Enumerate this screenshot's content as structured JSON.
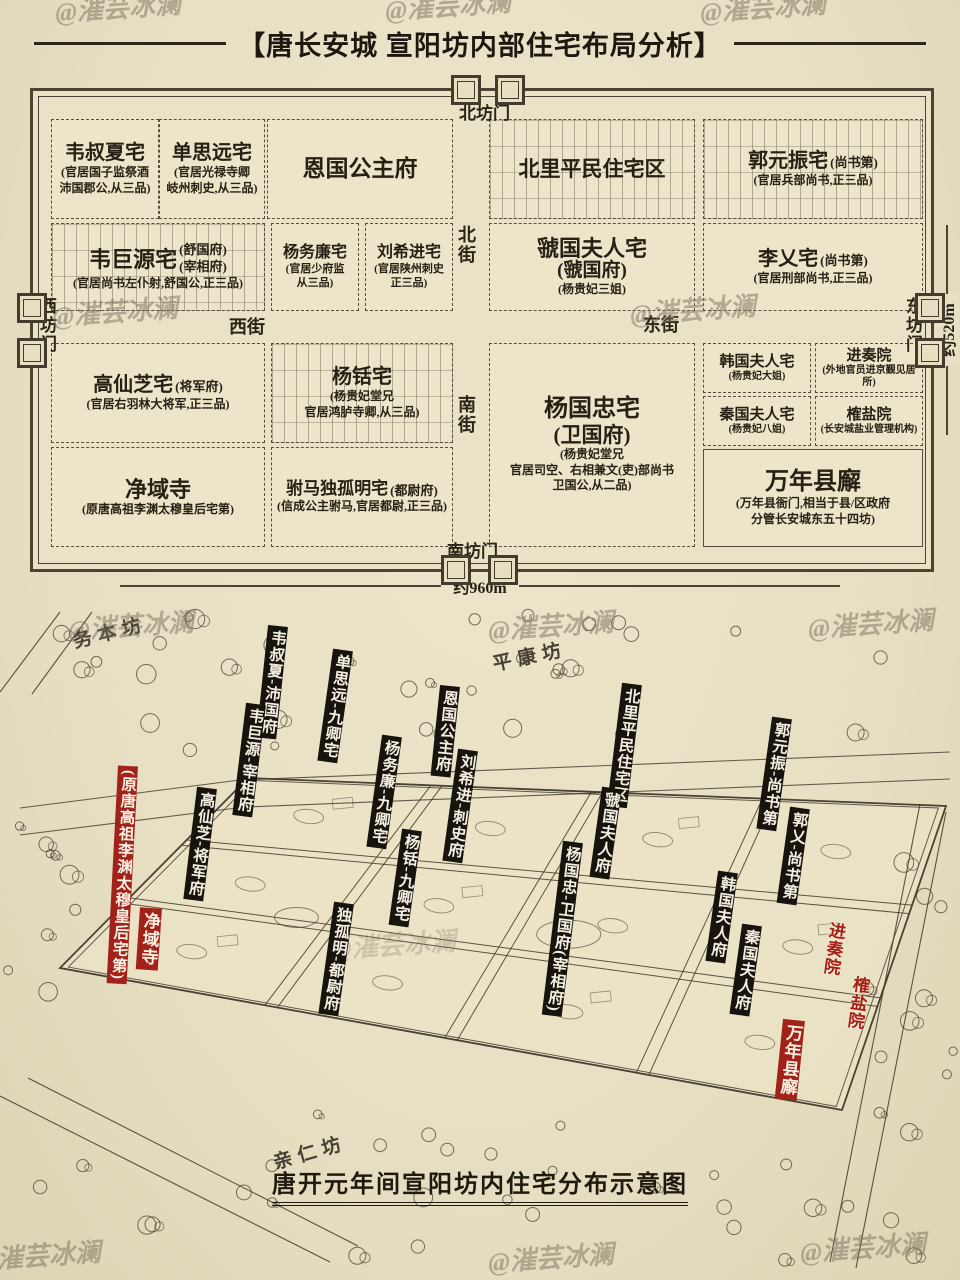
{
  "watermark": "@漼芸冰澜",
  "header": {
    "title": "【唐长安城 宣阳坊内部住宅布局分析】"
  },
  "plan": {
    "gates": {
      "north": "北坊门",
      "south": "南坊门",
      "west": "西坊门",
      "east": "东坊门"
    },
    "streets": {
      "north": "北街",
      "south": "南街",
      "west": "西街",
      "east": "东街"
    },
    "scale": {
      "width": "约960m",
      "height": "约520m"
    },
    "cells": {
      "weishuxia": {
        "name": "韦叔夏宅",
        "sub": "(官居国子监祭酒\n沛国郡公,从三品)"
      },
      "shansiyuan": {
        "name": "单思远宅",
        "sub": "(官居光禄寺卿\n岐州刺史,从三品)"
      },
      "enguo": {
        "name": "恩国公主府"
      },
      "beili": {
        "name": "北里平民住宅区"
      },
      "guoyuanzhen": {
        "name": "郭元振宅",
        "tag": "(尚书第)",
        "sub": "(官居兵部尚书,正三品)"
      },
      "weijuyuan": {
        "name": "韦巨源宅",
        "tags": "(舒国府)\n(宰相府)",
        "sub": "(官居尚书左仆射,舒国公,正三品)"
      },
      "yangwulian": {
        "name": "杨务廉宅",
        "sub": "(官居少府监\n从三品)"
      },
      "liuxijin": {
        "name": "刘希进宅",
        "sub": "(官居陕州刺史\n正三品)"
      },
      "guoguo": {
        "name": "虢国夫人宅",
        "l2": "(虢国府)",
        "sub": "(杨贵妃三姐)"
      },
      "liyi": {
        "name": "李乂宅",
        "tag": "(尚书第)",
        "sub": "(官居刑部尚书,正三品)"
      },
      "gaoxianzhi": {
        "name": "高仙芝宅",
        "tag": "(将军府)",
        "sub": "(官居右羽林大将军,正三品)"
      },
      "yangxian": {
        "name": "杨铦宅",
        "sub": "(杨贵妃堂兄\n官居鸿胪寺卿,从三品)"
      },
      "yangguozhong": {
        "name": "杨国忠宅",
        "l2": "(卫国府)",
        "sub": "(杨贵妃堂兄\n官居司空、右相兼文(吏)部尚书\n卫国公,从二品)"
      },
      "hanguo": {
        "name": "韩国夫人宅",
        "sub": "(杨贵妃大姐)"
      },
      "jinzouyuan": {
        "name": "进奏院",
        "sub": "(外地官员进京觐见居所)"
      },
      "qinguo": {
        "name": "秦国夫人宅",
        "sub": "(杨贵妃八姐)"
      },
      "queyanyuan": {
        "name": "榷盐院",
        "sub": "(长安城盐业管理机构)"
      },
      "jingyusi": {
        "name": "净域寺",
        "sub": "(原唐高祖李渊太穆皇后宅第)"
      },
      "dugu": {
        "name": "驸马独孤明宅",
        "tag": "(都尉府)",
        "sub": "(信成公主驸马,官居都尉,正三品)"
      },
      "wannian": {
        "name": "万年县廨",
        "sub": "(万年县衙门,相当于县/区政府\n分管长安城东五十四坊)"
      }
    }
  },
  "illustration": {
    "wards": {
      "wuben": "务本坊",
      "pingkang": "平康坊",
      "qinren": "亲仁坊"
    },
    "labels": {
      "weishuxia": "韦叔夏-沛国府",
      "shansiyuan": "单思远-九卿宅",
      "weijuyuan": "韦巨源-宰相府",
      "enguo": "恩国公主府",
      "yangwulian": "杨务廉-九卿宅",
      "liuxijin": "刘希进-刺史府",
      "beili": "北里平民住宅区",
      "guoguo": "虢国夫人府",
      "guoyuanzhen": "郭元振-尚书第",
      "guoyi": "郭乂-尚书第",
      "gaoxianzhi": "高仙芝-将军府",
      "yangxian": "杨铦-九卿宅",
      "dugu": "独孤明-都尉府",
      "yangguozhong": "杨国忠-卫国府(宰相府)",
      "hanguo": "韩国夫人府",
      "qinguo": "秦国夫人府",
      "yuanji": "(原唐高祖李渊太穆皇后宅第)",
      "jingyusi": "净域寺",
      "wannian": "万年县廨",
      "jinzouyuan": "进奏院",
      "queyanyuan": "榷盐院"
    },
    "caption": "唐开元年间宣阳坊内住宅分布示意图"
  }
}
